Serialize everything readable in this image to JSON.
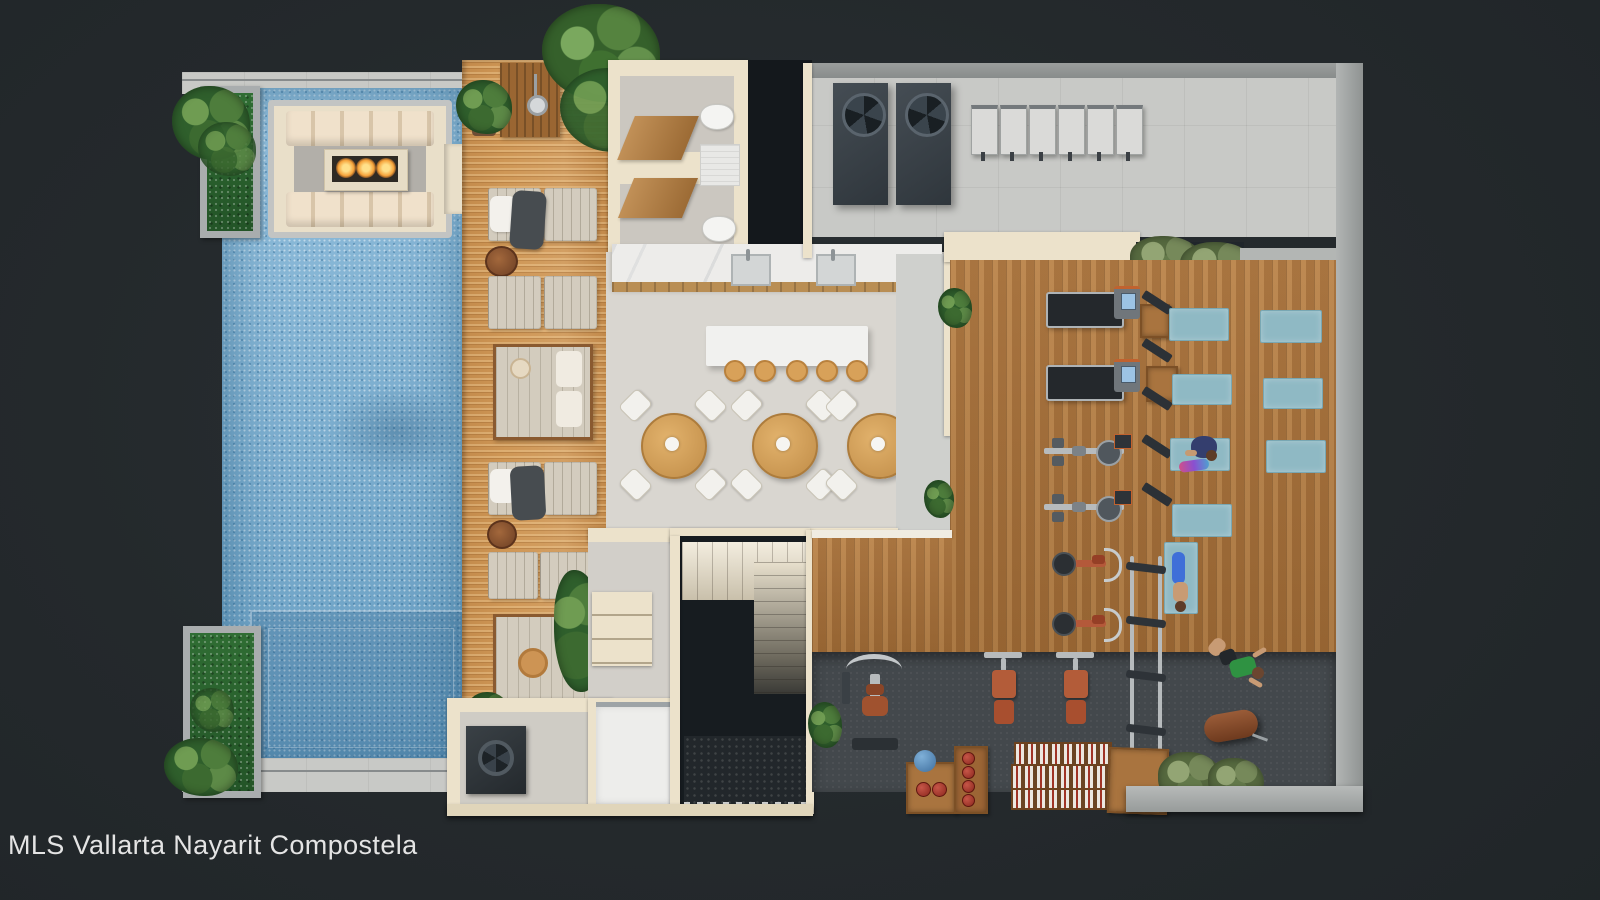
{
  "watermark": {
    "text": "MLS Vallarta Nayarit Compostela"
  },
  "palette": {
    "background": "#24292c",
    "pool_water": "#7fb4d7",
    "deck_wood": "#cf9756",
    "gym_wood": "#b1793f",
    "rubber_floor": "#43484c",
    "wall_beige": "#ece2cb",
    "concrete_gray": "#c8c9c6",
    "planter_green": "#2f6d33",
    "yoga_mat_teal": "#8fb9c4",
    "leather_brown": "#b35c39",
    "fire_orange": "#f6a33a",
    "watermark_text": "#e4e4e4"
  },
  "scene": {
    "type": "3d-floorplan-render",
    "areas": [
      "swimming-pool",
      "sunken-fire-lounge",
      "sun-deck",
      "outdoor-shower",
      "restrooms",
      "kitchen-counter",
      "bar-island",
      "dining-area",
      "mechanical-terrace",
      "gym-cardio-area",
      "yoga-area",
      "free-weights-area",
      "stairwell",
      "elevator",
      "equipment-room"
    ],
    "counts": {
      "dining_tables": 3,
      "bar_stools": 5,
      "sun_loungers": 8,
      "daybeds": 2,
      "yoga_mats": 7,
      "treadmills": 2,
      "rowing_machines": 2,
      "spin_bikes": 2,
      "weight_benches": 2,
      "hvac_fan_units": 2,
      "heat_pump_units": 6,
      "toilets": 2,
      "people": 3
    }
  }
}
